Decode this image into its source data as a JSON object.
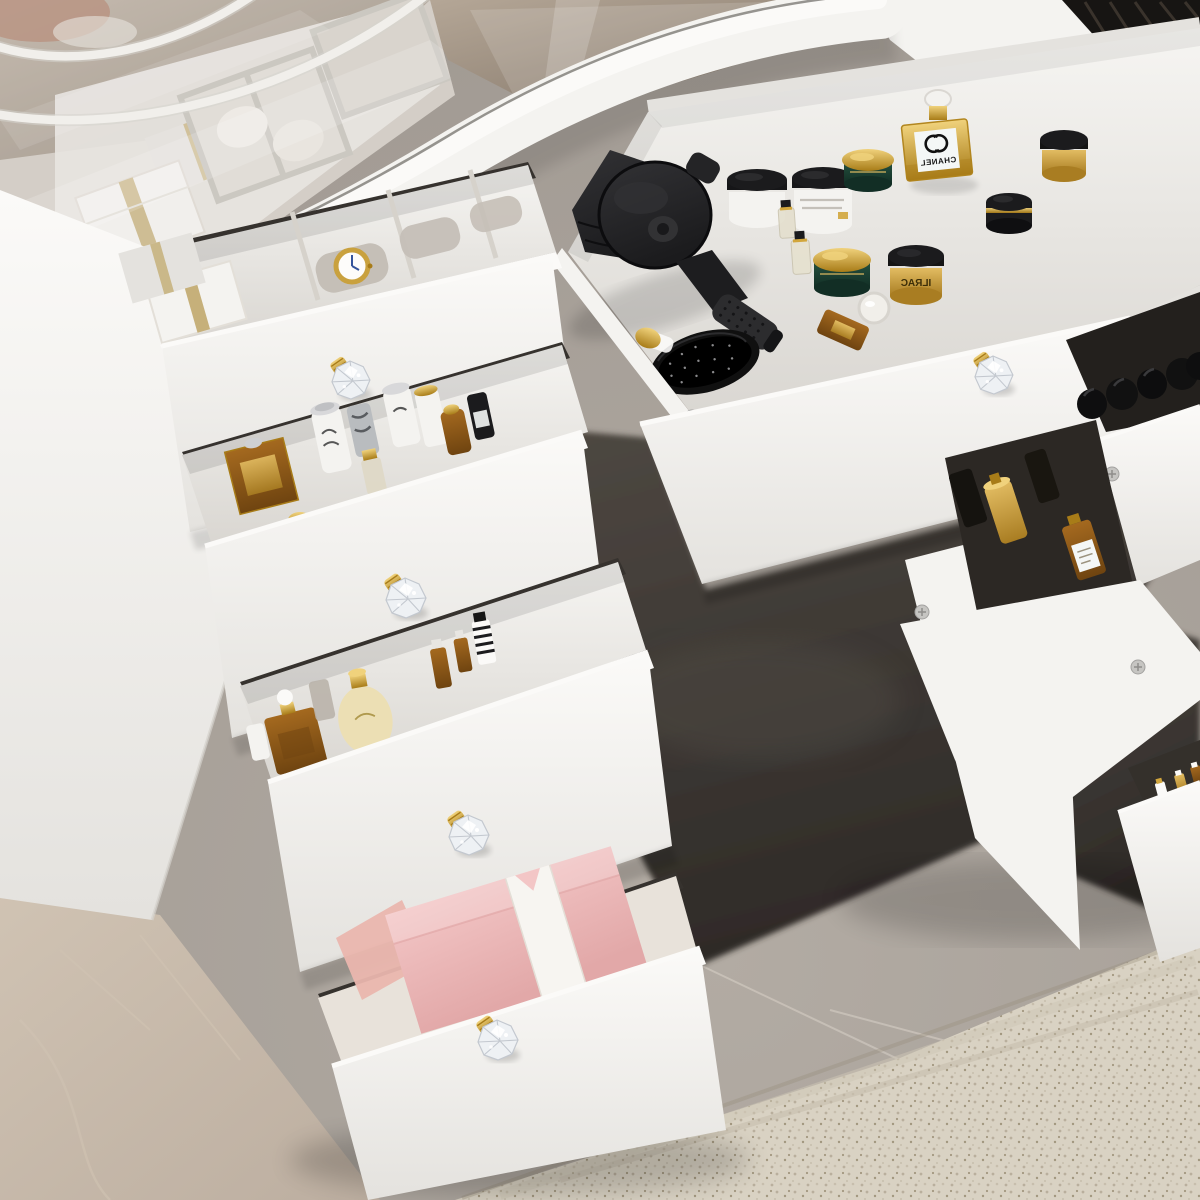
{
  "scene": {
    "description": "Top-down view of a white makeup vanity dressing table with a glass display top and cascading open drawers full of cosmetics, standing on grey and beige marble floor with a beige carpet at the lower right",
    "style": "3D product render photo"
  },
  "furniture": {
    "type": "vanity dressing table",
    "finish": "white",
    "knob_style": "crystal diamond knob with gold base",
    "visible_knobs": 5,
    "open_drawers": 9
  },
  "glass_cabinet": {
    "contents": [
      "white gift box with gold ribbon",
      "white gift box with gold ribbon",
      "jewelry tray compartments",
      "round cream jars"
    ],
    "cable": "white power cable on glass top"
  },
  "center_drawer": {
    "items": [
      "black hair dryer",
      "black round hair brush",
      "white cream jar with black lid",
      "white cream jar with black lid",
      "green jar with gold lid",
      "green jar with gold lid",
      "gold jar with black lid",
      "black jar with gold band",
      "gold perfume bottle with white label",
      "mini glass perfume bottle",
      "mini glass perfume bottle",
      "amber perfume with glass ball stopper",
      "gold-capped bottle"
    ],
    "chanel_perfume": {
      "label": "CHANEL"
    },
    "gold_jar": {
      "label": "ILRAC"
    }
  },
  "left_drawers": [
    {
      "name": "watch drawer",
      "items": [
        "gold wristwatch with white dial",
        "watch pillows",
        "white gift boxes with gold ribbon"
      ]
    },
    {
      "name": "perfume drawer",
      "items": [
        "gold boxed perfume",
        "white spray bottles",
        "gold-capped bottles",
        "black bottle"
      ]
    },
    {
      "name": "lotion drawer",
      "items": [
        "amber perfume with gold cap and white ball",
        "cream lotion bottle",
        "amber dropper bottles",
        "striped bottle"
      ]
    },
    {
      "name": "gift drawer",
      "items": [
        "pink gift box with white ribbon",
        "pink tissue paper"
      ]
    }
  ],
  "right_drawers": [
    {
      "name": "top right drawer",
      "items": [
        "row of black bottles"
      ]
    },
    {
      "name": "middle right drawer",
      "items": [
        "gold spray bottle",
        "amber bottle with label"
      ]
    },
    {
      "name": "lower right drawer",
      "items": [
        "mini white and gold bottles"
      ]
    }
  ],
  "floor": {
    "materials": [
      "grey marble tile",
      "beige marble tile",
      "dark shadowed floor",
      "beige speckled carpet"
    ]
  },
  "colors": {
    "white_bright": "#fbfaf8",
    "white_face": "#f4f3f0",
    "white_shade": "#e4e2de",
    "white_deep": "#d4d1cc",
    "interior": "#f6f5f2",
    "interior_shade": "#d9d6d1",
    "band_seam": "#7d7a75",
    "glass_tint": "#cdc7bf",
    "bronze": "#9a8b7c",
    "bronze_dark": "#7b6e61",
    "bronze_light": "#b5a797",
    "copper": "#a8735c",
    "slot_dark": "#36322e",
    "organizer_dark": "#171513",
    "floor_grey": "#a09992",
    "floor_grey_light": "#b2aba3",
    "floor_crack": "#d2cbc2",
    "floor_beige": "#bcaea0",
    "floor_beige_light": "#d0c3b3",
    "floor_dark": "#4e4842",
    "floor_dark2": "#2e2a27",
    "rug_base": "#d9d2c3",
    "rug_dot1": "#b9af9d",
    "rug_dot2": "#a2977f",
    "rug_dot3": "#c7bead",
    "gold_light": "#f0d27c",
    "gold": "#d2a63c",
    "gold_dark": "#a87c18",
    "gold_jar_light": "#e2bc62",
    "gold_jar_dark": "#a97d22",
    "green_jar": "#24503e",
    "green_jar_dark": "#122e25",
    "amber": "#a4691f",
    "amber_dark": "#6f4410",
    "black_item": "#1b1b1d",
    "black_item_light": "#323235",
    "label_white": "#f4f7f6",
    "pink_box": "#f3c6c6",
    "pink_box_dark": "#e2a8a8",
    "pink_tissue": "#eab6ae",
    "ribbon_white": "#f7f5f1",
    "ribbon_gold": "#c6b07a",
    "crystal": "#eef1f4",
    "crystal_edge": "#c3c8cf",
    "crystal_high": "#ffffff",
    "watch_gold": "#c9a13e",
    "watch_hand": "#35549b",
    "pillow_grey": "#c5bfb7",
    "cream_bottle": "#ecdfb4",
    "screw": "#c6c5c2",
    "screw_slot": "#8e8d8a",
    "cable": "#f1efeb",
    "cable_shade": "#d6d3cd"
  }
}
